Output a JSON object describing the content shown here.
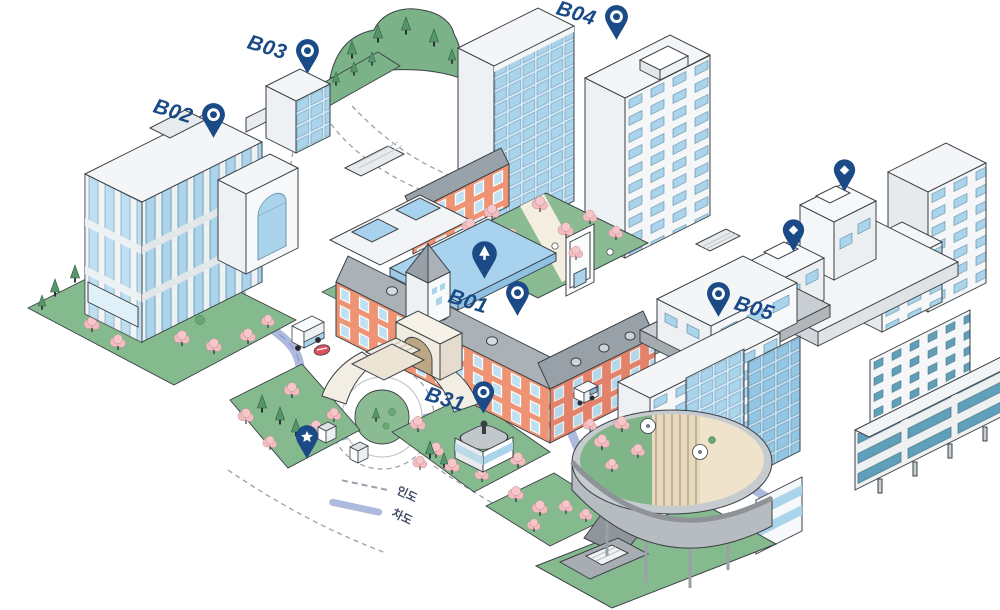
{
  "map": {
    "type": "isometric-campus-map",
    "markers": {
      "b01": {
        "label": "B01",
        "glyph": "ring-pin"
      },
      "b02": {
        "label": "B02",
        "glyph": "ring-pin"
      },
      "b03": {
        "label": "B03",
        "glyph": "ring-pin"
      },
      "b04": {
        "label": "B04",
        "glyph": "ring-pin"
      },
      "b05": {
        "label": "B05",
        "glyph": "ring-pin"
      },
      "b31": {
        "label": "B31",
        "glyph": "ring-pin"
      },
      "poi_tree": {
        "label": "",
        "glyph": "tree-pin"
      },
      "poi_star": {
        "label": "",
        "glyph": "star-pin"
      },
      "poi_diamond_1": {
        "label": "",
        "glyph": "diamond-pin"
      },
      "poi_diamond_2": {
        "label": "",
        "glyph": "diamond-pin"
      }
    },
    "legend": {
      "items": [
        {
          "label": "인도",
          "style": "dashed-line"
        },
        {
          "label": "차도",
          "style": "solid-line"
        }
      ]
    },
    "colors": {
      "accent_navy": "#1b4b87",
      "road": "#aeb9de",
      "lawn_green": "#85b98e",
      "hill_green": "#7cb287",
      "blossom_pink": "#f3bcbe",
      "window_blue": "#a9d4ec",
      "window_teal": "#5f9fb9",
      "brick_orange": "#ee9474",
      "flat_roof_blue": "#a8d2ee",
      "outline": "#3b4046"
    }
  }
}
